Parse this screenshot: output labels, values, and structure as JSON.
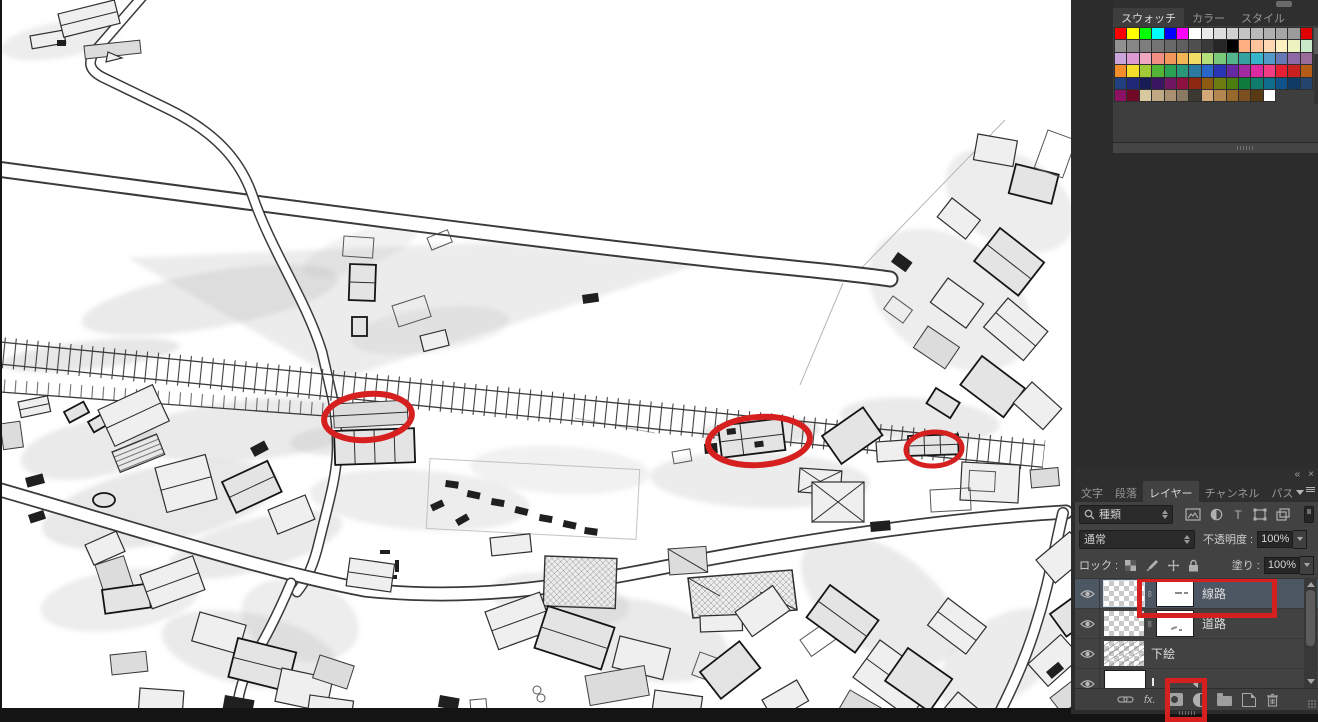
{
  "swatches_panel": {
    "tabs": [
      {
        "label": "スウォッチ",
        "active": true
      },
      {
        "label": "カラー",
        "active": false
      },
      {
        "label": "スタイル",
        "active": false
      }
    ],
    "swatch_rows": [
      [
        "#ff0000",
        "#ffff00",
        "#00ff00",
        "#00ffff",
        "#0000ff",
        "#ff00ff",
        "#ffffff",
        "#ebebeb",
        "#dddddd",
        "#d0d0d0",
        "#c4c4c4",
        "#bababa",
        "#b0b0b0",
        "#a6a6a6",
        "#9b9b9b",
        "#e00000"
      ],
      [
        "#919191",
        "#878787",
        "#7d7d7d",
        "#737373",
        "#696969",
        "#5f5f5f",
        "#4f4f4f",
        "#3a3a3a",
        "#262626",
        "#000000",
        "#ffaf82",
        "#ffc49b",
        "#ffd8b4",
        "#fff0c3",
        "#ecf2c0",
        "#c9e8c9"
      ],
      [
        "#c9a5dc",
        "#dd9ad2",
        "#f2a7c0",
        "#f28e84",
        "#f2975c",
        "#f2b553",
        "#f2dd67",
        "#b5dd7a",
        "#7ac97a",
        "#53b58e",
        "#35a1a1",
        "#35b5c9",
        "#539ac9",
        "#6679b5",
        "#8d68a5",
        "#996b99"
      ],
      [
        "#f28d2a",
        "#f2dd2a",
        "#a1c935",
        "#53b535",
        "#2aa153",
        "#2a977a",
        "#2a7aa1",
        "#2a66c9",
        "#2a35b5",
        "#6629a1",
        "#a12aa1",
        "#dd2aa1",
        "#f23d84",
        "#e61f35",
        "#c92020",
        "#b55c16"
      ],
      [
        "#204080",
        "#202878",
        "#181c55",
        "#3a1560",
        "#701560",
        "#8c1040",
        "#8c2810",
        "#8c5a10",
        "#6d7c10",
        "#4a7c10",
        "#107c3c",
        "#107c6e",
        "#106e8c",
        "#10538c",
        "#0f3c64",
        "#25456e"
      ],
      [
        "#8c1064",
        "#700a28",
        "#d8c8a0",
        "#c0a884",
        "#a89070",
        "#8a7a62",
        "#3c3832",
        "#d2a878",
        "#b48650",
        "#96682c",
        "#7c501e",
        "#5a3a14",
        "#ffffff",
        null,
        null,
        null
      ]
    ]
  },
  "layers_panel": {
    "header": {
      "collapse_icon": "«",
      "close_icon": "×"
    },
    "tabs": [
      {
        "label": "文字",
        "active": false
      },
      {
        "label": "段落",
        "active": false
      },
      {
        "label": "レイヤー",
        "active": true
      },
      {
        "label": "チャンネル",
        "active": false
      },
      {
        "label": "パス",
        "active": false
      }
    ],
    "filter_row": {
      "kind_label": "種類"
    },
    "blend_row": {
      "mode": "通常",
      "opacity_label": "不透明度 :",
      "opacity_value": "100%"
    },
    "lock_row": {
      "lock_label": "ロック :",
      "fill_label": "塗り :",
      "fill_value": "100%"
    },
    "layers": [
      {
        "name": "線路",
        "selected": true,
        "has_mask": true,
        "annotated": true
      },
      {
        "name": "道路",
        "selected": false,
        "has_mask": true
      },
      {
        "name": "下絵",
        "selected": false,
        "has_mask": false
      },
      {
        "name": "",
        "selected": false,
        "has_mask": false,
        "partial": true
      }
    ],
    "bottom_bar": {
      "fx_label": "fx."
    }
  },
  "annotations": {
    "color": "#d62020",
    "canvas_ellipse_count": 3,
    "highlighted_ui": [
      "線路 layer mask and name",
      "add layer mask button"
    ]
  }
}
